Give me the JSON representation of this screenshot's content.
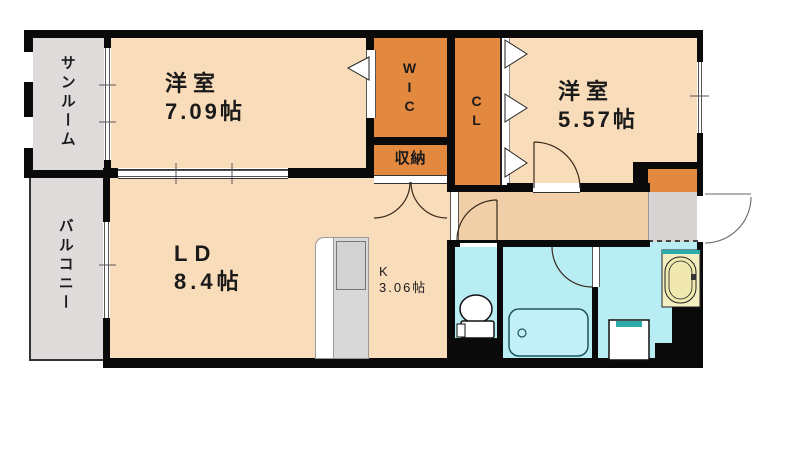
{
  "title": "apartment-floor-plan",
  "colors": {
    "wall": "#0a0a0a",
    "room": "#f9dcba",
    "hall": "#f1cfa8",
    "closet": "#e2893f",
    "wet": "#b9edf4",
    "grayroom": "#dfdbdb",
    "entry": "#d9d4d4",
    "counter": "#d8d8d8",
    "basin": "#f4eec2",
    "teal": "#2aacaa",
    "text": "#1a1a1a"
  },
  "rooms": {
    "sunroom": {
      "label": "サンルーム"
    },
    "bedroom1": {
      "label": "洋室",
      "size": "7.09帖"
    },
    "wic": {
      "label": "WIC"
    },
    "closet": {
      "label": "CL"
    },
    "bedroom2": {
      "label": "洋室",
      "size": "5.57帖"
    },
    "storage": {
      "label": "収納"
    },
    "living": {
      "label": "LD",
      "size": "8.4帖"
    },
    "kitchen": {
      "label": "K",
      "size": "3.06帖"
    },
    "balcony": {
      "label": "バルコニー"
    }
  },
  "fixtures": {
    "toilet": "toilet-icon",
    "bathtub": "bathtub-icon",
    "washing_machine": "washing-machine-pan-icon",
    "washbasin": "washbasin-icon",
    "kitchen_counter": "kitchen-counter-icon",
    "entrance_door": "entrance-door-swing-icon",
    "folding_doors": "folding-door-triangles-icon"
  }
}
